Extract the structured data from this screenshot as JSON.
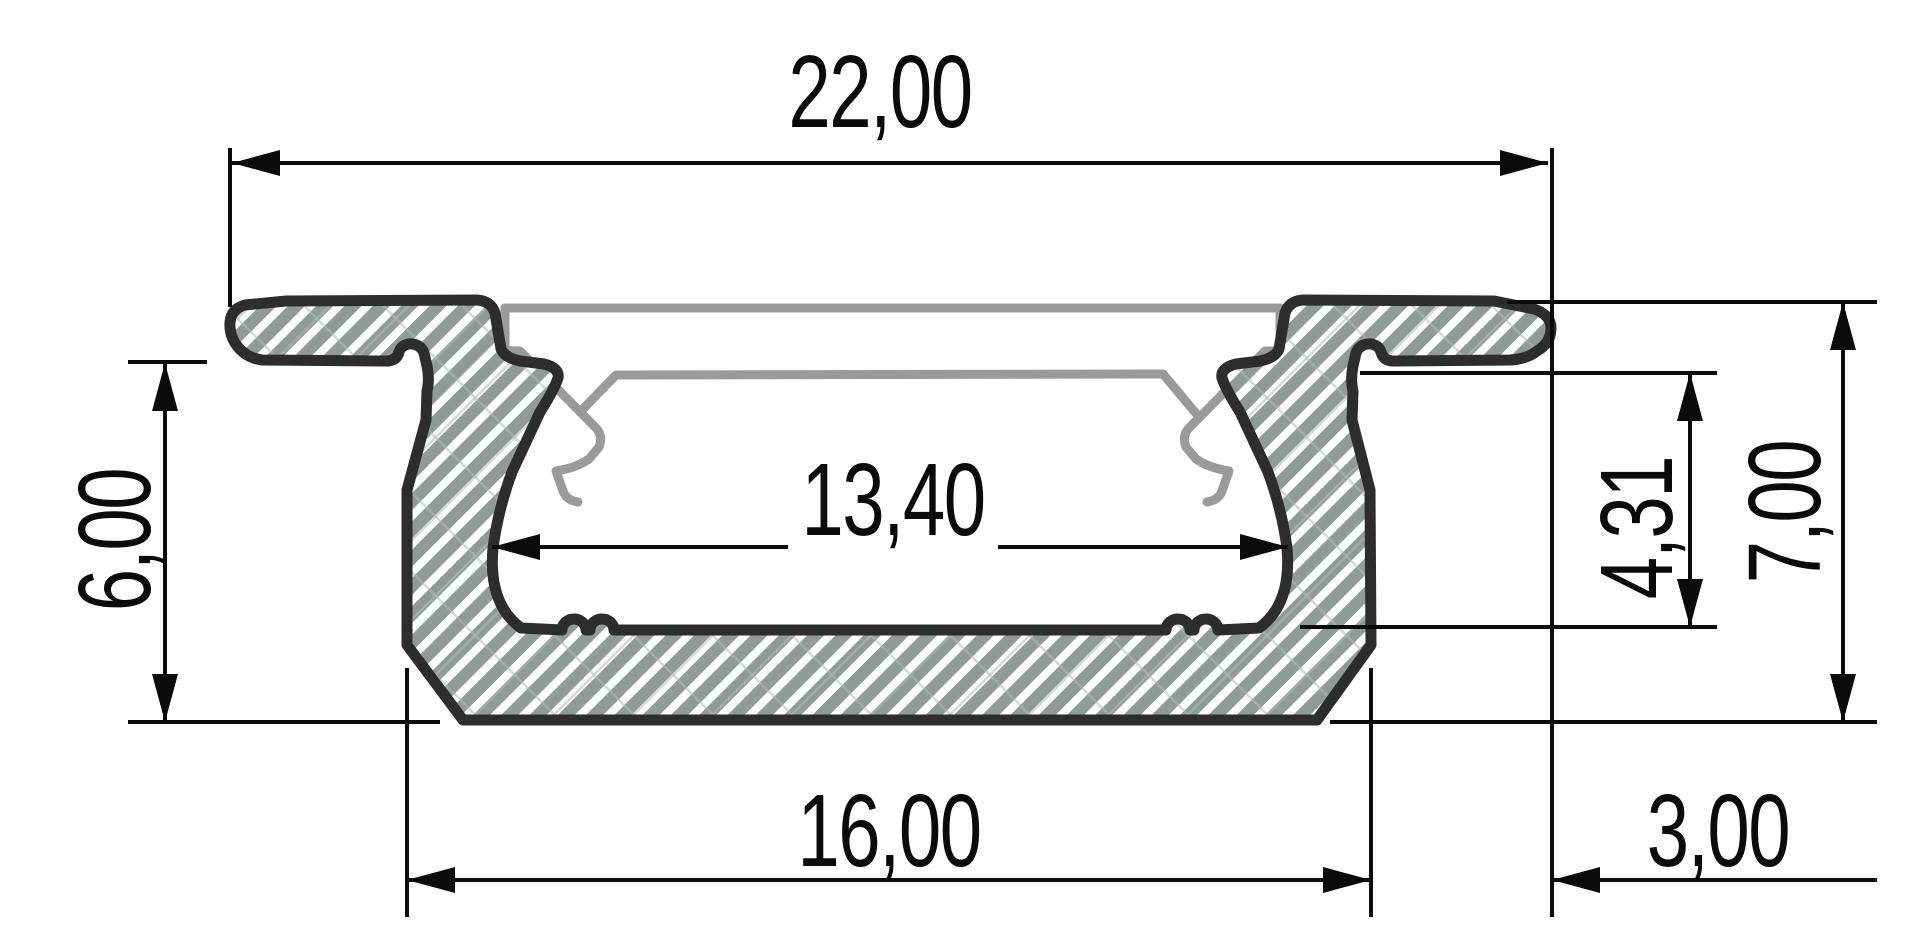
{
  "drawing": {
    "type": "technical-cross-section",
    "subject": "recessed-led-aluminium-profile",
    "units_format": "comma-decimal",
    "dimensions": {
      "overall_width": "22,00",
      "inner_width": "13,40",
      "body_width": "16,00",
      "flange_overhang": "3,00",
      "body_height": "6,00",
      "inner_depth": "4,31",
      "overall_height": "7,00"
    },
    "colors": {
      "outline": "#2d2d2d",
      "hatch_fill": "#8d9c97",
      "hatch_grid": "#aebcb7",
      "cover_outline": "#9a9a9a",
      "dimension_lines": "#0b0b0b",
      "background": "#ffffff"
    }
  }
}
